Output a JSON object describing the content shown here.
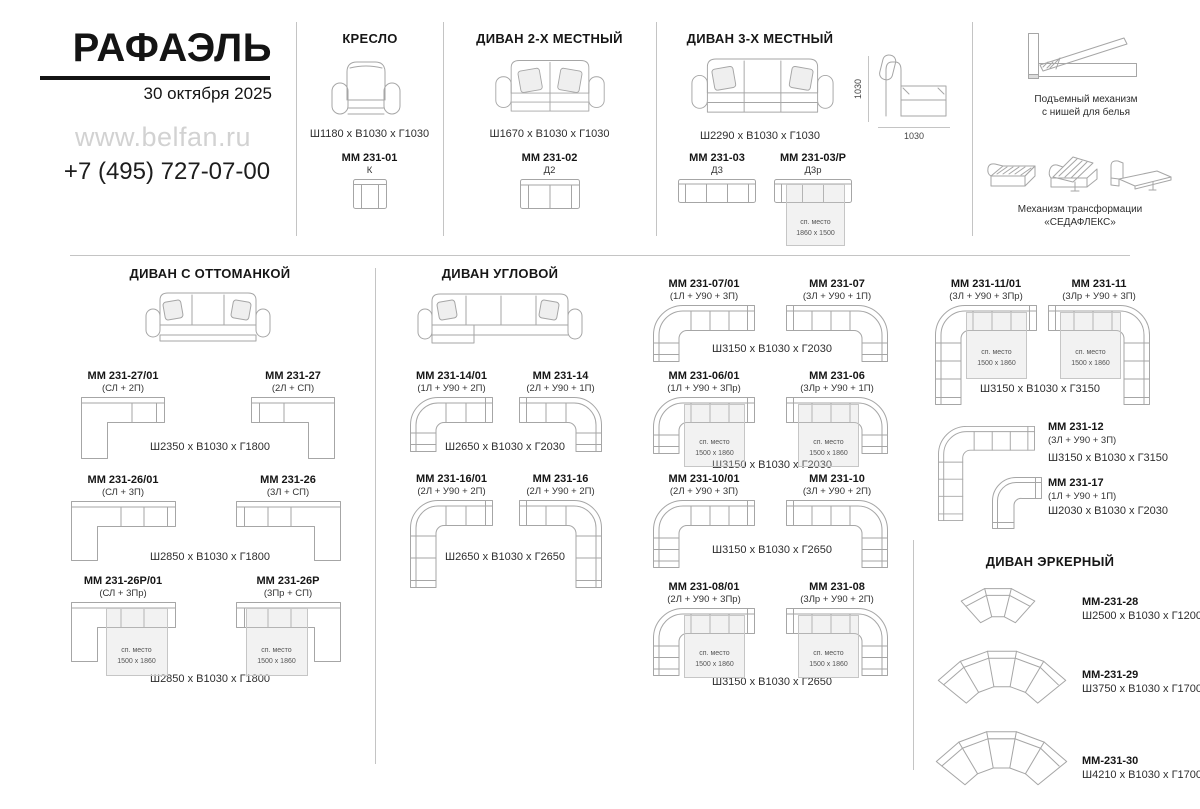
{
  "brand": {
    "name": "РАФАЭЛЬ",
    "date": "30 октября 2025",
    "website": "www.belfan.ru",
    "phone": "+7 (495) 727-07-00"
  },
  "labels": {
    "sleep": "сп. место",
    "sleep_size": "1500 x 1860",
    "sleep_size_3seat": "1860 x 1500"
  },
  "armchair": {
    "title": "КРЕСЛО",
    "dims": "Ш1180 x В1030 x Г1030",
    "model": "ММ 231-01",
    "config": "К"
  },
  "sofa2": {
    "title": "ДИВАН 2-Х МЕСТНЫЙ",
    "dims": "Ш1670 x В1030 x Г1030",
    "model": "ММ 231-02",
    "config": "Д2"
  },
  "sofa3": {
    "title": "ДИВАН 3-Х МЕСТНЫЙ",
    "dims": "Ш2290 x В1030 x Г1030",
    "height_label": "1030",
    "depth_label": "1030",
    "model_a": "ММ 231-03",
    "config_a": "Д3",
    "model_b": "ММ 231-03/Р",
    "config_b": "Д3р"
  },
  "mechanisms": {
    "lift_line1": "Подъемный механизм",
    "lift_line2": "с нишей для белья",
    "transform_line1": "Механизм трансформации",
    "transform_line2": "«СЕДАФЛЕКС»"
  },
  "ottoman": {
    "title": "ДИВАН С ОТТОМАНКОЙ",
    "rows": [
      {
        "l_model": "ММ 231-27/01",
        "l_config": "(СЛ + 2П)",
        "r_model": "ММ 231-27",
        "r_config": "(2Л + СП)",
        "dims": "Ш2350 x В1030 x Г1800"
      },
      {
        "l_model": "ММ 231-26/01",
        "l_config": "(СЛ + 3П)",
        "r_model": "ММ 231-26",
        "r_config": "(3Л + СП)",
        "dims": "Ш2850 x В1030 x Г1800"
      },
      {
        "l_model": "ММ 231-26Р/01",
        "l_config": "(СЛ + 3Пр)",
        "r_model": "ММ 231-26Р",
        "r_config": "(3Пр + СП)",
        "dims": "Ш2850 x В1030 x Г1800"
      }
    ]
  },
  "corner": {
    "title": "ДИВАН УГЛОВОЙ",
    "pairs": [
      {
        "l_model": "ММ 231-14/01",
        "l_config": "(1Л + У90 + 2П)",
        "r_model": "ММ 231-14",
        "r_config": "(2Л + У90 + 1П)",
        "dims": "Ш2650 x В1030 x Г2030"
      },
      {
        "l_model": "ММ 231-16/01",
        "l_config": "(2Л + У90 + 2П)",
        "r_model": "ММ 231-16",
        "r_config": "(2Л + У90 + 2П)",
        "dims": "Ш2650 x В1030 x Г2650"
      },
      {
        "l_model": "ММ 231-07/01",
        "l_config": "(1Л + У90 + 3П)",
        "r_model": "ММ 231-07",
        "r_config": "(3Л + У90 + 1П)",
        "dims": "Ш3150 x В1030 x Г2030"
      },
      {
        "l_model": "ММ 231-06/01",
        "l_config": "(1Л + У90 + 3Пр)",
        "r_model": "ММ 231-06",
        "r_config": "(3Лр + У90 + 1П)",
        "dims": "Ш3150 x В1030 x Г2030"
      },
      {
        "l_model": "ММ 231-10/01",
        "l_config": "(2Л + У90 + 3П)",
        "r_model": "ММ 231-10",
        "r_config": "(3Л + У90 + 2П)",
        "dims": "Ш3150 x В1030 x Г2650"
      },
      {
        "l_model": "ММ 231-08/01",
        "l_config": "(2Л + У90 + 3Пр)",
        "r_model": "ММ 231-08",
        "r_config": "(3Лр + У90 + 2П)",
        "dims": "Ш3150 x В1030 x Г2650"
      },
      {
        "l_model": "ММ 231-11/01",
        "l_config": "(3Л + У90 + 3Пр)",
        "r_model": "ММ 231-11",
        "r_config": "(3Лр + У90 + 3П)",
        "dims": "Ш3150 x В1030 x Г3150"
      }
    ],
    "singles": [
      {
        "model": "ММ 231-12",
        "config": "(3Л + У90 + 3П)",
        "dims": "Ш3150 x В1030 x Г3150"
      },
      {
        "model": "ММ 231-17",
        "config": "(1Л + У90 + 1П)",
        "dims": "Ш2030 x В1030 x Г2030"
      }
    ]
  },
  "bay": {
    "title": "ДИВАН ЭРКЕРНЫЙ",
    "items": [
      {
        "model": "ММ-231-28",
        "dims": "Ш2500 x В1030 x Г1200"
      },
      {
        "model": "ММ-231-29",
        "dims": "Ш3750 x В1030 x Г1700"
      },
      {
        "model": "ММ-231-30",
        "dims": "Ш4210 x В1030 x Г1700"
      }
    ]
  }
}
